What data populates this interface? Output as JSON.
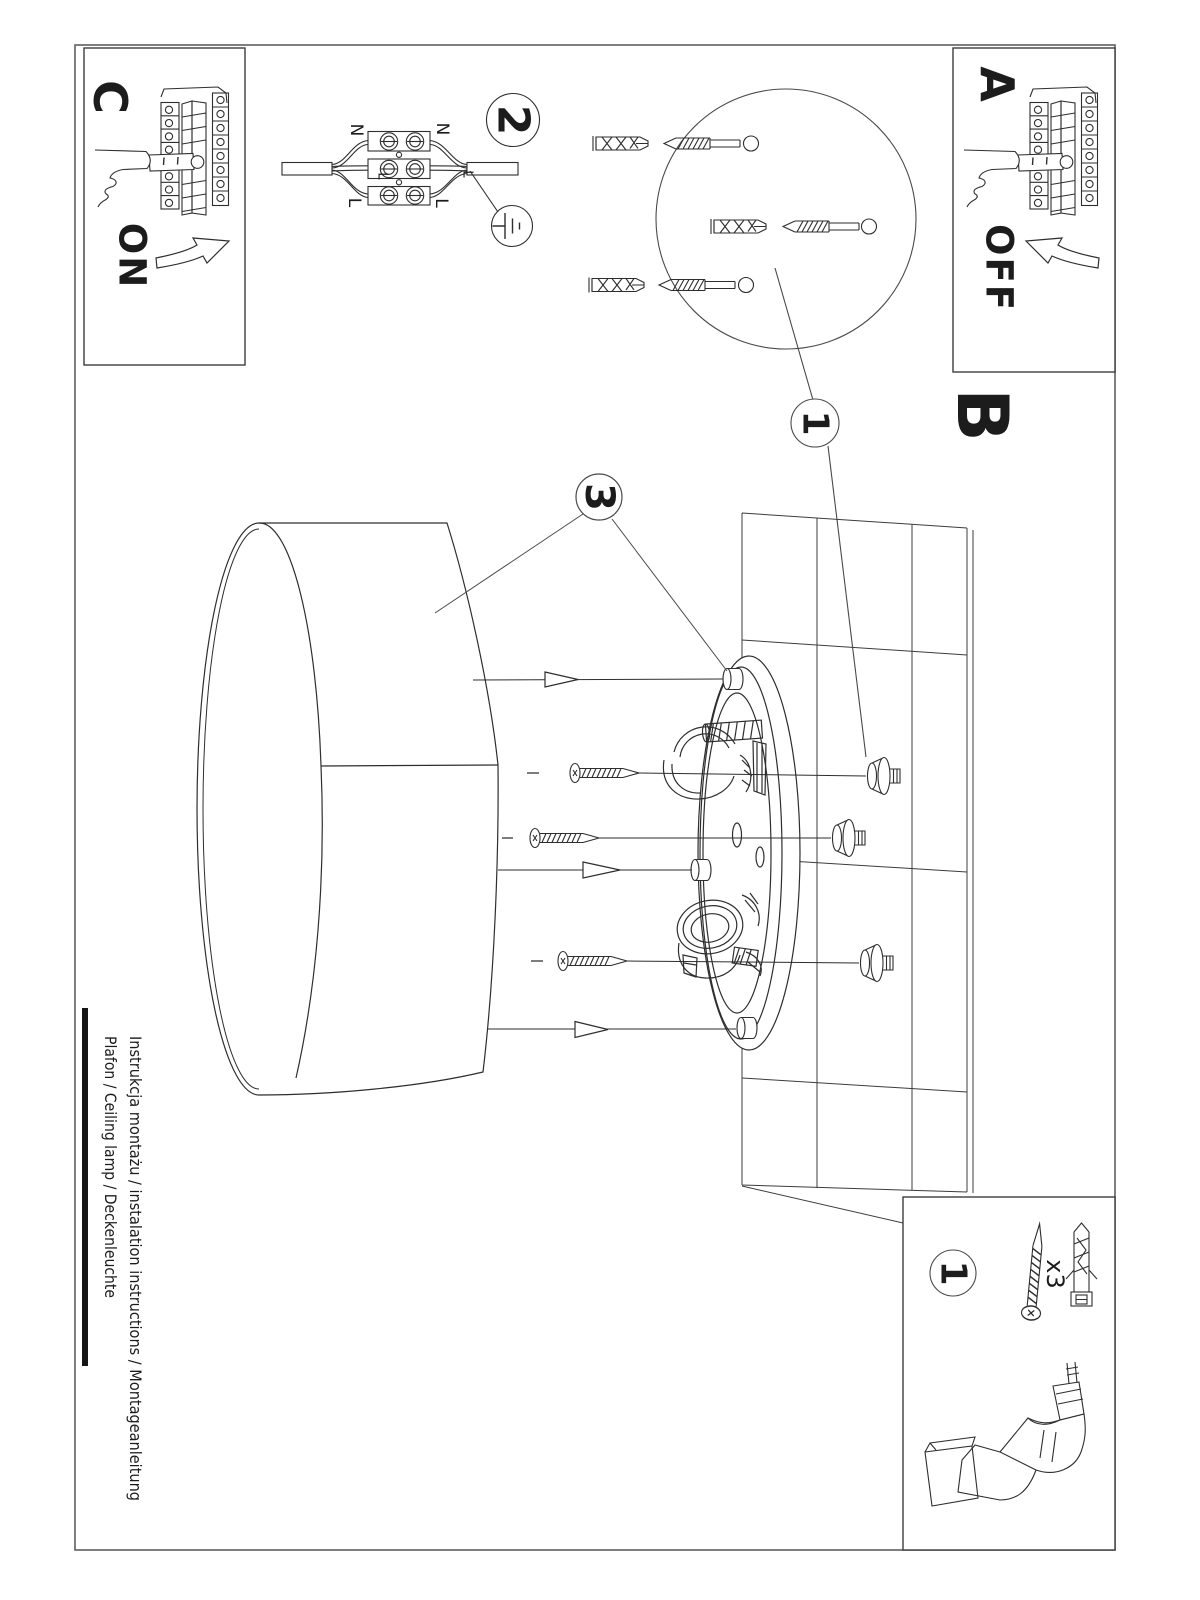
{
  "document": {
    "footer": {
      "line1": "Instrukcja montażu / instalation instructions / Montageanleitung",
      "line2": "Plafon / Ceiling lamp / Deckenleuchte"
    }
  },
  "steps": {
    "a": {
      "label": "A",
      "state": "OFF"
    },
    "b": {
      "label": "B"
    },
    "c": {
      "label": "C",
      "state": "ON"
    }
  },
  "callouts": {
    "mounting_detail": "1",
    "wiring_detail": "2",
    "shade_detail": "3",
    "parts_item": "1"
  },
  "wiring": {
    "n_left": "N",
    "n_right": "N",
    "l_left": "L",
    "l_right": "L",
    "l_mid_left": "L",
    "l_mid_right": "L"
  },
  "parts": {
    "screw_plug_qty": "x3"
  },
  "colors": {
    "ink": "#222222",
    "frame": "#6a6a6a",
    "paper": "#ffffff"
  }
}
